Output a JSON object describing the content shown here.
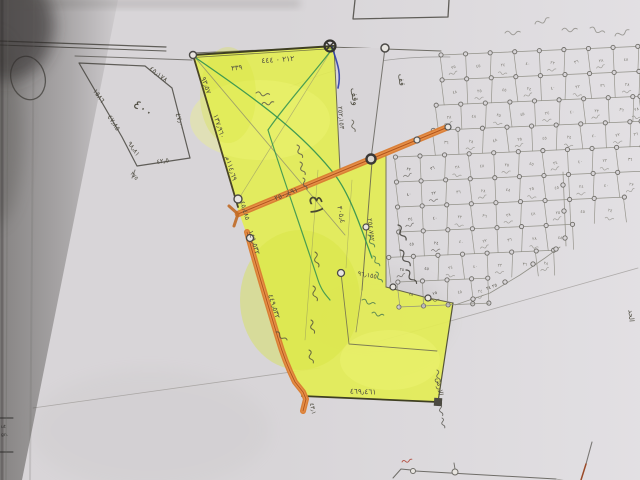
{
  "meta": {
    "title": "Hand-drawn cadastral survey map (photograph of paper plan)",
    "language": "Arabic"
  },
  "colors": {
    "paper": "#d8d5d8",
    "paper_light": "#eceaee",
    "shadow": "#35332f",
    "pencil": "#5f5d58",
    "pencil_light": "#8b897f",
    "graphite_dark": "#3f3f22",
    "highlight_yellow": "#e3ed55",
    "highlight_yellow_deep": "#d6e33e",
    "highlight_yellow_pale": "#f0f77a",
    "road_orange": "#e08134",
    "road_orange_dark": "#a84e18",
    "ink_green": "#2f9150",
    "ink_blue": "#2d3da8",
    "ink_red": "#b04030"
  },
  "parcel": {
    "number": "٤١",
    "left_parcel_area": "٤٠٠"
  },
  "annotations": [
    {
      "id": "lp-edge-nw",
      "text": "١٥٨٦",
      "x": 97,
      "y": 97,
      "rot": 55,
      "size": 7
    },
    {
      "id": "lp-edge-w",
      "text": "٤٧٫٨٥",
      "x": 112,
      "y": 124,
      "rot": 57,
      "size": 7
    },
    {
      "id": "lp-edge-ne",
      "text": "٤٥٫١٧٨",
      "x": 157,
      "y": 76,
      "rot": 38,
      "size": 7
    },
    {
      "id": "lp-edge-e",
      "text": "٤٧٫٠٠",
      "x": 178,
      "y": 122,
      "rot": 72,
      "size": 7
    },
    {
      "id": "lp-edge-sw",
      "text": "٩٨٫٨١",
      "x": 132,
      "y": 150,
      "rot": 55,
      "size": 6.5
    },
    {
      "id": "lp-edge-s",
      "text": "٤٢٫٥",
      "x": 163,
      "y": 163,
      "rot": -8,
      "size": 6.5
    },
    {
      "id": "lp-area",
      "text": "٤٠٠",
      "x": 141,
      "y": 112,
      "rot": 33,
      "size": 13
    },
    {
      "id": "lp-corner",
      "text": "٢٧٥",
      "x": 133,
      "y": 177,
      "rot": 50,
      "size": 5.5
    },
    {
      "id": "top-edge-len",
      "text": "٢١٢ ٠ ٤٤٤",
      "x": 278,
      "y": 62,
      "rot": -4,
      "size": 7.5
    },
    {
      "id": "top-edge-len2",
      "text": "٣٣٩",
      "x": 237,
      "y": 70,
      "rot": -6,
      "size": 7
    },
    {
      "id": "west-edge-1",
      "text": "٩٣٫٥٧",
      "x": 204,
      "y": 86,
      "rot": 70,
      "size": 7
    },
    {
      "id": "west-edge-2",
      "text": "١٣٧٫٩٦٠",
      "x": 217,
      "y": 127,
      "rot": 72,
      "size": 7
    },
    {
      "id": "west-edge-3",
      "text": "١١٤٫٦٩م",
      "x": 229,
      "y": 169,
      "rot": 73,
      "size": 7
    },
    {
      "id": "west-edge-4",
      "text": "٤٥٫٤٨٥",
      "x": 243,
      "y": 211,
      "rot": 74,
      "size": 6.5
    },
    {
      "id": "inner-edge-1",
      "text": "٢٥٢٫١٥٣",
      "x": 339,
      "y": 118,
      "rot": 85,
      "size": 6.5
    },
    {
      "id": "road-a-len",
      "text": "٢٥٠٫٤٩١",
      "x": 287,
      "y": 196,
      "rot": -22,
      "size": 7
    },
    {
      "id": "road-b-len-1",
      "text": "١٤٩٫٥٣٢",
      "x": 252,
      "y": 243,
      "rot": 73,
      "size": 7
    },
    {
      "id": "road-b-len-2",
      "text": "٤٤٩٫٥٣٢",
      "x": 272,
      "y": 307,
      "rot": 72,
      "size": 7
    },
    {
      "id": "parcel-number",
      "text": "٤١",
      "x": 310,
      "y": 206,
      "rot": 85,
      "size": 20,
      "color": "#4a4a32"
    },
    {
      "id": "inner-edge-2",
      "text": "٢٥٤٫٧٥٢",
      "x": 369,
      "y": 230,
      "rot": 84,
      "size": 6.5
    },
    {
      "id": "inner-edge-3",
      "text": "٣٠٥٫٤",
      "x": 339,
      "y": 215,
      "rot": 78,
      "size": 7
    },
    {
      "id": "inner-len",
      "text": "٩٦٫١٥٥",
      "x": 367,
      "y": 277,
      "rot": 10,
      "size": 6.5
    },
    {
      "id": "south-edge-len",
      "text": "٤٦٩٫٤٦١",
      "x": 363,
      "y": 394,
      "rot": 2,
      "size": 7.5
    },
    {
      "id": "road-b-end",
      "text": "٤٣٫١",
      "x": 311,
      "y": 409,
      "rot": 78,
      "size": 6
    },
    {
      "id": "wedge-word",
      "text": "وقف",
      "x": 352,
      "y": 97,
      "rot": 82,
      "size": 9
    },
    {
      "id": "wedge-word-2",
      "text": "قف",
      "x": 399,
      "y": 80,
      "rot": 85,
      "size": 8
    },
    {
      "id": "east-note",
      "text": "حد الارض",
      "x": 438,
      "y": 392,
      "rot": 83,
      "size": 7
    },
    {
      "id": "right-margin",
      "text": "الحد",
      "x": 629,
      "y": 316,
      "rot": 85,
      "size": 7
    },
    {
      "id": "grid-bottom-num",
      "text": "٢٥ ٢٤",
      "x": 492,
      "y": 288,
      "rot": -20,
      "size": 4.5
    }
  ],
  "grid": {
    "cell_marks": [
      "٢٥",
      "٤٥",
      "٢٤",
      "٤٠",
      "٢٢",
      "٣٦",
      "٢٨",
      "٤٨"
    ],
    "point_radius": 2.1
  },
  "edge_print": {
    "lines": [
      "ut",
      "gn."
    ]
  }
}
